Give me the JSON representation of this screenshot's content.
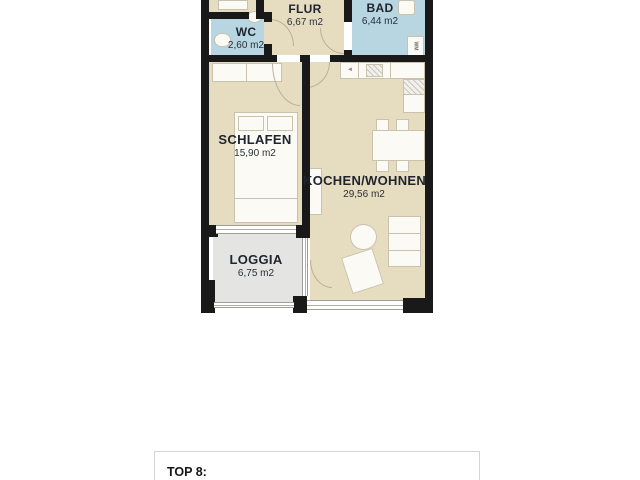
{
  "floorplan": {
    "rooms": [
      {
        "id": "wc",
        "name": "WC",
        "area": "2,60 m2"
      },
      {
        "id": "flur",
        "name": "FLUR",
        "area": "6,67 m2"
      },
      {
        "id": "bad",
        "name": "BAD",
        "area": "6,44 m2"
      },
      {
        "id": "schlafen",
        "name": "SCHLAFEN",
        "area": "15,90 m2"
      },
      {
        "id": "kochen_wohnen",
        "name": "KOCHEN/WOHNEN",
        "area": "29,56 m2"
      },
      {
        "id": "loggia",
        "name": "LOGGIA",
        "area": "6,75 m2"
      }
    ],
    "appliances": {
      "washing_machine": "WM"
    },
    "colors": {
      "room_beige": "#e6ddc1",
      "room_blue": "#b7d6e1",
      "room_gray": "#e4e4e2",
      "wall": "#191919",
      "label_text": "#20242e",
      "furniture": "#fbfaf5"
    }
  },
  "footer": {
    "unit_label": "TOP 8:"
  }
}
